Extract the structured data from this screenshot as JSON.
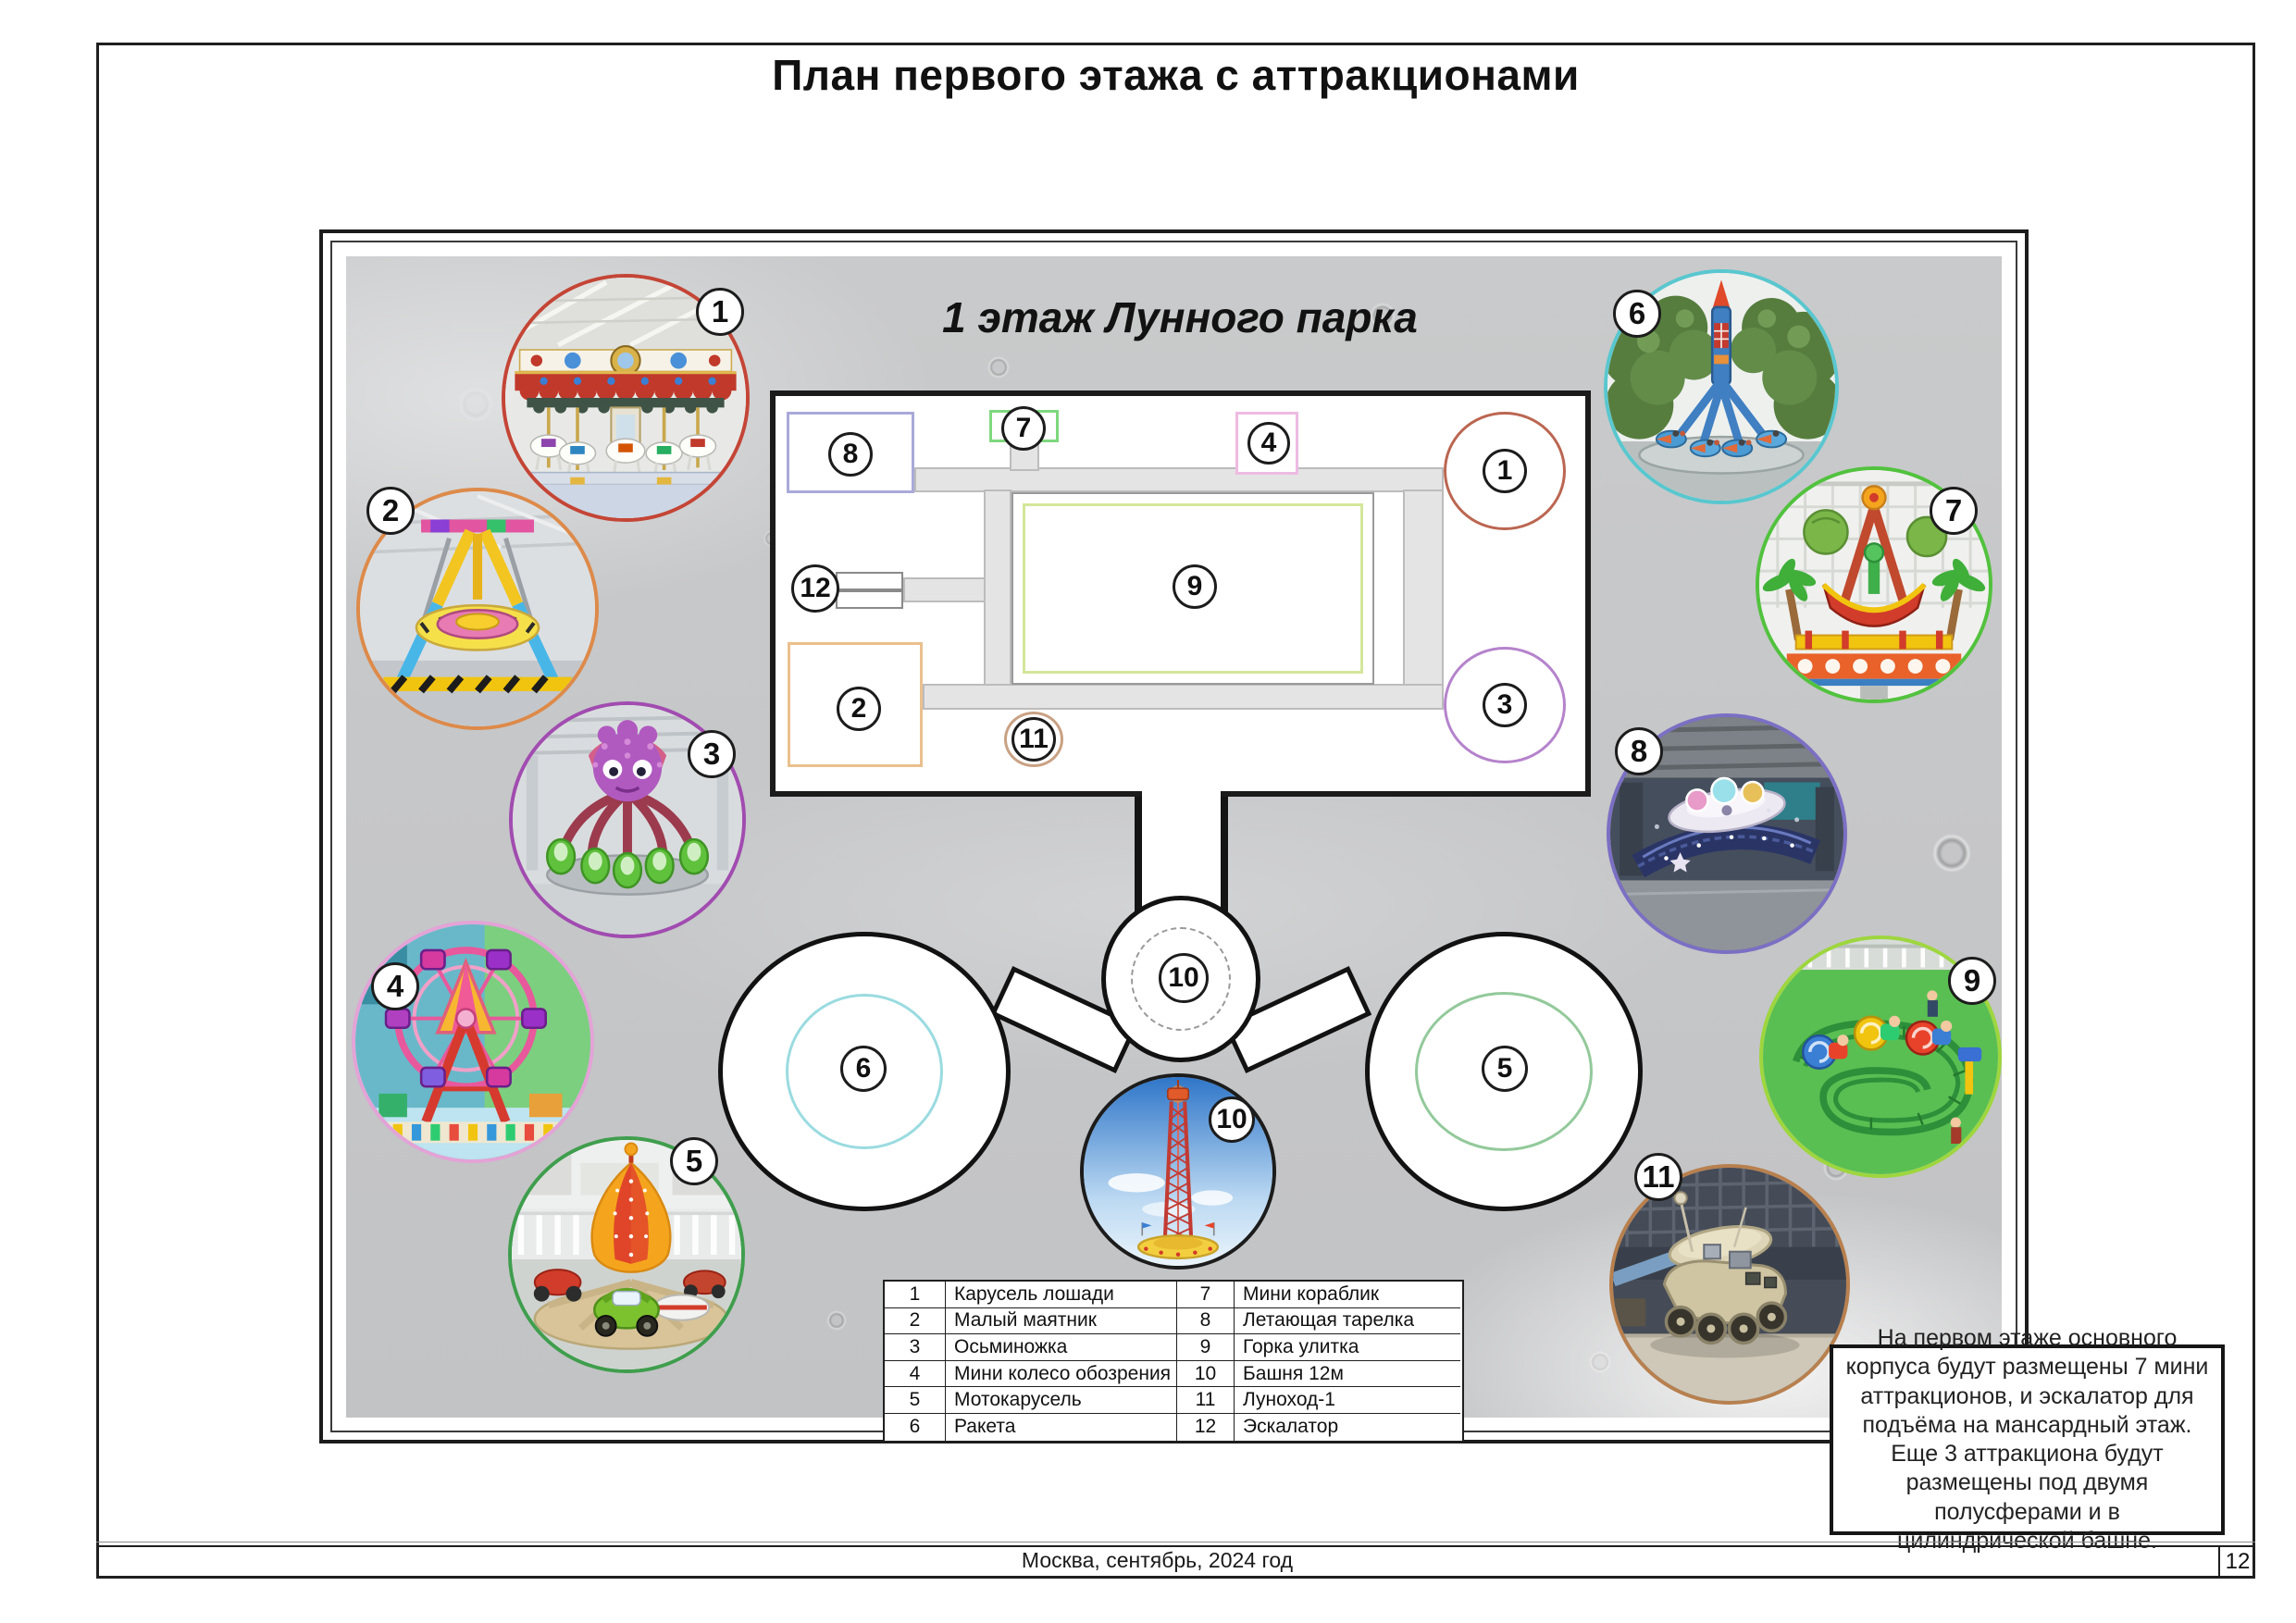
{
  "page": {
    "title": "План первого этажа с аттракционами",
    "footer_text": "Москва, сентябрь, 2024 год",
    "page_number": "12"
  },
  "plan": {
    "title": "1 этаж Лунного парка",
    "badges": {
      "b1": "1",
      "b2": "2",
      "b3": "3",
      "b4": "4",
      "b7": "7",
      "b8": "8",
      "b9": "9",
      "b11": "11",
      "b12": "12",
      "hub": "10",
      "e5": "5",
      "e6": "6"
    }
  },
  "photos": [
    {
      "num": "1",
      "alt": "Карусель лошади",
      "border_color": "#c44536"
    },
    {
      "num": "2",
      "alt": "Малый маятник",
      "border_color": "#dd8a4a"
    },
    {
      "num": "3",
      "alt": "Осьминожка",
      "border_color": "#a14cb0"
    },
    {
      "num": "4",
      "alt": "Мини колесо обозрения",
      "border_color": "#e3a3d6"
    },
    {
      "num": "5",
      "alt": "Мотокарусель",
      "border_color": "#3f9e4d"
    },
    {
      "num": "6",
      "alt": "Ракета",
      "border_color": "#59c7cf"
    },
    {
      "num": "7",
      "alt": "Мини кораблик",
      "border_color": "#52c23e"
    },
    {
      "num": "8",
      "alt": "Летающая тарелка",
      "border_color": "#7b6fc4"
    },
    {
      "num": "9",
      "alt": "Горка улитка",
      "border_color": "#9ed63e"
    },
    {
      "num": "10",
      "alt": "Башня 12м",
      "border_color": "#1c1c1c"
    },
    {
      "num": "11",
      "alt": "Луноход-1",
      "border_color": "#b8804e"
    }
  ],
  "legend": {
    "rows": [
      {
        "c0": "1",
        "c1": "Карусель лошади",
        "c2": "7",
        "c3": "Мини кораблик"
      },
      {
        "c0": "2",
        "c1": "Малый маятник",
        "c2": "8",
        "c3": "Летающая тарелка"
      },
      {
        "c0": "3",
        "c1": "Осьминожка",
        "c2": "9",
        "c3": "Горка улитка"
      },
      {
        "c0": "4",
        "c1": "Мини колесо обозрения",
        "c2": "10",
        "c3": "Башня 12м"
      },
      {
        "c0": "5",
        "c1": "Мотокарусель",
        "c2": "11",
        "c3": "Луноход-1"
      },
      {
        "c0": "6",
        "c1": "Ракета",
        "c2": "12",
        "c3": "Эскалатор"
      }
    ]
  },
  "note": {
    "text": "На первом этаже основного корпуса будут размещены 7 мини аттракционов, и эскалатор для подъёма на мансардный этаж. Еще 3 аттракциона будут размещены под двумя полусферами и в цилиндрической башне."
  }
}
